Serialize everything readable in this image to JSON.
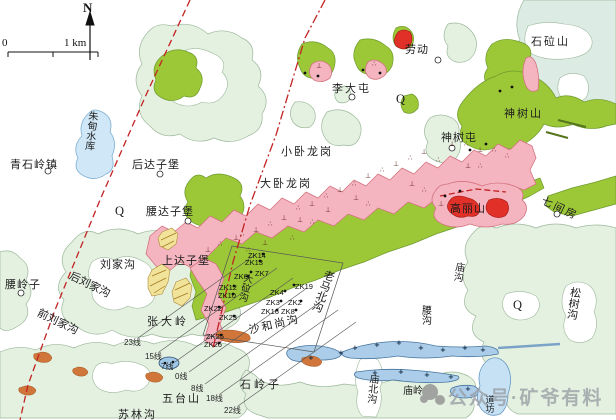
{
  "map": {
    "compass_label": "N",
    "scale": {
      "zero": "0",
      "unit": "1 km"
    },
    "watermark": "公众号·矿爷有料",
    "colors": {
      "pale_hills": "#e4f1e1",
      "hill_outline": "#9cb89b",
      "intrusion_green": "#9cc838",
      "volcanic_pink": "#f5b5c0",
      "pink_outline": "#d4737f",
      "ore_red": "#e03028",
      "sill_blue": "#abcde9",
      "water_blue": "#cfe7f6",
      "lens_orange": "#d0763b",
      "schist_yellow": "#f2e39a",
      "fault_red": "#c22222"
    },
    "labels": [
      {
        "t": "劳动",
        "x": 405,
        "y": 45,
        "ls": 1
      },
      {
        "t": "石砬山",
        "x": 531,
        "y": 37,
        "ls": 2
      },
      {
        "t": "李大屯",
        "x": 332,
        "y": 84,
        "ls": 2
      },
      {
        "t": "Q",
        "x": 396,
        "y": 93,
        "cls": "q"
      },
      {
        "t": "神树山",
        "x": 504,
        "y": 109,
        "ls": 2
      },
      {
        "t": "神树屯",
        "x": 441,
        "y": 133,
        "ls": 1
      },
      {
        "t": "朱甸水库",
        "x": 86,
        "y": 110,
        "v": 1,
        "s": 10,
        "r": 6
      },
      {
        "t": "青石岭镇",
        "x": 10,
        "y": 160,
        "ls": 1
      },
      {
        "t": "后达子堡",
        "x": 132,
        "y": 160,
        "ls": 1
      },
      {
        "t": "Q",
        "x": 115,
        "y": 205,
        "cls": "q"
      },
      {
        "t": "小卧龙岗",
        "x": 281,
        "y": 147,
        "ls": 2
      },
      {
        "t": "大卧龙岗",
        "x": 260,
        "y": 179,
        "ls": 2
      },
      {
        "t": "腰达子堡",
        "x": 146,
        "y": 207,
        "ls": 1
      },
      {
        "t": "高丽山",
        "x": 450,
        "y": 204,
        "ls": 1
      },
      {
        "t": "七间房",
        "x": 544,
        "y": 196,
        "r": 25,
        "ls": 2
      },
      {
        "t": "刘家沟",
        "x": 100,
        "y": 260,
        "ls": 1
      },
      {
        "t": "上达子堡",
        "x": 162,
        "y": 256,
        "ls": 1
      },
      {
        "t": "腰岭子",
        "x": 5,
        "y": 280,
        "ls": 1
      },
      {
        "t": "后刘家沟",
        "x": 72,
        "y": 271,
        "r": 26
      },
      {
        "t": "前刘家沟",
        "x": 40,
        "y": 308,
        "r": 26
      },
      {
        "t": "张大岭",
        "x": 147,
        "y": 317,
        "ls": 3
      },
      {
        "t": "大砬沟",
        "x": 242,
        "y": 272,
        "v": 1,
        "r": 14,
        "s": 9.5
      },
      {
        "t": "老马北沟",
        "x": 324,
        "y": 268,
        "v": 1,
        "r": 20
      },
      {
        "t": "沙和尚沟",
        "x": 248,
        "y": 326,
        "r": -13,
        "ls": 2
      },
      {
        "t": "石岭子",
        "x": 240,
        "y": 380,
        "ls": 3
      },
      {
        "t": "五台山",
        "x": 162,
        "y": 394,
        "ls": 2
      },
      {
        "t": "庙沟",
        "x": 453,
        "y": 261,
        "v": 1,
        "r": 8,
        "s": 10
      },
      {
        "t": "腰沟",
        "x": 419,
        "y": 305,
        "v": 1,
        "s": 10
      },
      {
        "t": "Q",
        "x": 513,
        "y": 299,
        "cls": "q"
      },
      {
        "t": "松树沟",
        "x": 569,
        "y": 286,
        "v": 1,
        "r": 8
      },
      {
        "t": "庙北沟",
        "x": 367,
        "y": 373,
        "v": 1,
        "r": 6,
        "s": 10
      },
      {
        "t": "庙岭",
        "x": 403,
        "y": 387,
        "s": 10
      },
      {
        "t": "苏林沟",
        "x": 118,
        "y": 410,
        "ls": 2
      },
      {
        "t": "道坊",
        "x": 484,
        "y": 395,
        "v": 1,
        "s": 9
      }
    ],
    "zk_labels": [
      {
        "t": "ZK14",
        "x": 248,
        "y": 251
      },
      {
        "t": "ZK13",
        "x": 245,
        "y": 258
      },
      {
        "t": "ZK7",
        "x": 255,
        "y": 269
      },
      {
        "t": "ZK6",
        "x": 234,
        "y": 272
      },
      {
        "t": "ZK12",
        "x": 219,
        "y": 283
      },
      {
        "t": "ZK10",
        "x": 218,
        "y": 291
      },
      {
        "t": "ZK19",
        "x": 295,
        "y": 282
      },
      {
        "t": "ZK4",
        "x": 270,
        "y": 288
      },
      {
        "t": "ZK3",
        "x": 266,
        "y": 298
      },
      {
        "t": "ZK2",
        "x": 288,
        "y": 298
      },
      {
        "t": "ZK16",
        "x": 261,
        "y": 307
      },
      {
        "t": "ZK8",
        "x": 281,
        "y": 307
      },
      {
        "t": "ZK22",
        "x": 204,
        "y": 304
      },
      {
        "t": "ZK23",
        "x": 219,
        "y": 313
      },
      {
        "t": "ZK25",
        "x": 206,
        "y": 332
      },
      {
        "t": "ZK26",
        "x": 204,
        "y": 340
      }
    ],
    "line_labels": [
      {
        "t": "23线",
        "x": 124,
        "y": 337
      },
      {
        "t": "15线",
        "x": 145,
        "y": 351
      },
      {
        "t": "7线",
        "x": 161,
        "y": 361
      },
      {
        "t": "0线",
        "x": 175,
        "y": 371
      },
      {
        "t": "8线",
        "x": 191,
        "y": 383
      },
      {
        "t": "18线",
        "x": 206,
        "y": 393
      },
      {
        "t": "22线",
        "x": 224,
        "y": 405
      }
    ],
    "villages": [
      [
        438,
        60
      ],
      [
        352,
        97
      ],
      [
        452,
        148
      ],
      [
        160,
        174
      ],
      [
        48,
        171
      ],
      [
        188,
        221
      ],
      [
        21,
        293
      ],
      [
        557,
        214
      ]
    ],
    "dots": [
      [
        263,
        254
      ],
      [
        260,
        261
      ],
      [
        251,
        272
      ],
      [
        248,
        276
      ],
      [
        234,
        286
      ],
      [
        233,
        294
      ],
      [
        294,
        285
      ],
      [
        285,
        291
      ],
      [
        281,
        301
      ],
      [
        301,
        301
      ],
      [
        277,
        310
      ],
      [
        296,
        310
      ],
      [
        219,
        307
      ],
      [
        234,
        316
      ],
      [
        221,
        335
      ],
      [
        219,
        343
      ],
      [
        305,
        73
      ],
      [
        318,
        76
      ],
      [
        363,
        70
      ],
      [
        380,
        73
      ],
      [
        500,
        91
      ],
      [
        512,
        87
      ],
      [
        470,
        150
      ],
      [
        486,
        144
      ],
      [
        445,
        196
      ],
      [
        460,
        191
      ]
    ],
    "pink_symbols": [
      {
        "g": "⊥",
        "x": 253,
        "y": 232
      },
      {
        "g": "⊥",
        "x": 281,
        "y": 220
      },
      {
        "g": "⊥",
        "x": 309,
        "y": 206
      },
      {
        "g": "⊥",
        "x": 337,
        "y": 192
      },
      {
        "g": "⊥",
        "x": 365,
        "y": 178
      },
      {
        "g": "⊥",
        "x": 393,
        "y": 166
      },
      {
        "g": "⊥",
        "x": 421,
        "y": 154
      },
      {
        "g": "⊥",
        "x": 449,
        "y": 146
      },
      {
        "g": "⊥",
        "x": 477,
        "y": 152
      },
      {
        "g": "⊥",
        "x": 205,
        "y": 252
      },
      {
        "g": "⊥",
        "x": 233,
        "y": 240
      },
      {
        "g": "⊥",
        "x": 297,
        "y": 222
      },
      {
        "g": "⊥",
        "x": 353,
        "y": 200
      },
      {
        "g": "⊥",
        "x": 409,
        "y": 186
      },
      {
        "g": "⊥",
        "x": 465,
        "y": 168
      },
      {
        "g": "⊥",
        "x": 438,
        "y": 206
      },
      {
        "g": "⊥",
        "x": 325,
        "y": 212
      },
      {
        "g": "⊥",
        "x": 262,
        "y": 245
      },
      {
        "g": "⊥",
        "x": 316,
        "y": 68
      },
      {
        "g": "∴",
        "x": 240,
        "y": 236
      },
      {
        "g": "∴",
        "x": 268,
        "y": 226
      },
      {
        "g": "∴",
        "x": 296,
        "y": 210
      },
      {
        "g": "∴",
        "x": 324,
        "y": 198
      },
      {
        "g": "∴",
        "x": 352,
        "y": 186
      },
      {
        "g": "∴",
        "x": 380,
        "y": 172
      },
      {
        "g": "∴",
        "x": 408,
        "y": 160
      },
      {
        "g": "∴",
        "x": 436,
        "y": 162
      },
      {
        "g": "∴",
        "x": 464,
        "y": 146
      },
      {
        "g": "∴",
        "x": 492,
        "y": 152
      },
      {
        "g": "∴",
        "x": 218,
        "y": 246
      },
      {
        "g": "∴",
        "x": 246,
        "y": 252
      },
      {
        "g": "∴",
        "x": 310,
        "y": 224
      },
      {
        "g": "∴",
        "x": 366,
        "y": 206
      },
      {
        "g": "∴",
        "x": 422,
        "y": 192
      },
      {
        "g": "∴",
        "x": 478,
        "y": 168
      },
      {
        "g": "∴",
        "x": 290,
        "y": 240
      },
      {
        "g": "∴",
        "x": 455,
        "y": 210
      },
      {
        "g": "∴",
        "x": 505,
        "y": 158
      },
      {
        "g": "∴",
        "x": 198,
        "y": 262
      },
      {
        "g": "∴",
        "x": 372,
        "y": 66
      }
    ],
    "sill_symbols": [
      {
        "g": "+",
        "x": 352,
        "y": 350
      },
      {
        "g": "+",
        "x": 374,
        "y": 347
      },
      {
        "g": "+",
        "x": 396,
        "y": 345
      },
      {
        "g": "+",
        "x": 418,
        "y": 350
      },
      {
        "g": "+",
        "x": 440,
        "y": 352
      },
      {
        "g": "+",
        "x": 462,
        "y": 350
      },
      {
        "g": "+",
        "x": 480,
        "y": 352
      },
      {
        "g": "+",
        "x": 372,
        "y": 375
      },
      {
        "g": "+",
        "x": 398,
        "y": 374
      },
      {
        "g": "+",
        "x": 424,
        "y": 377
      },
      {
        "g": "+",
        "x": 448,
        "y": 379
      },
      {
        "g": "+",
        "x": 465,
        "y": 391
      },
      {
        "g": "+",
        "x": 308,
        "y": 360
      },
      {
        "g": "+",
        "x": 338,
        "y": 355
      }
    ]
  }
}
